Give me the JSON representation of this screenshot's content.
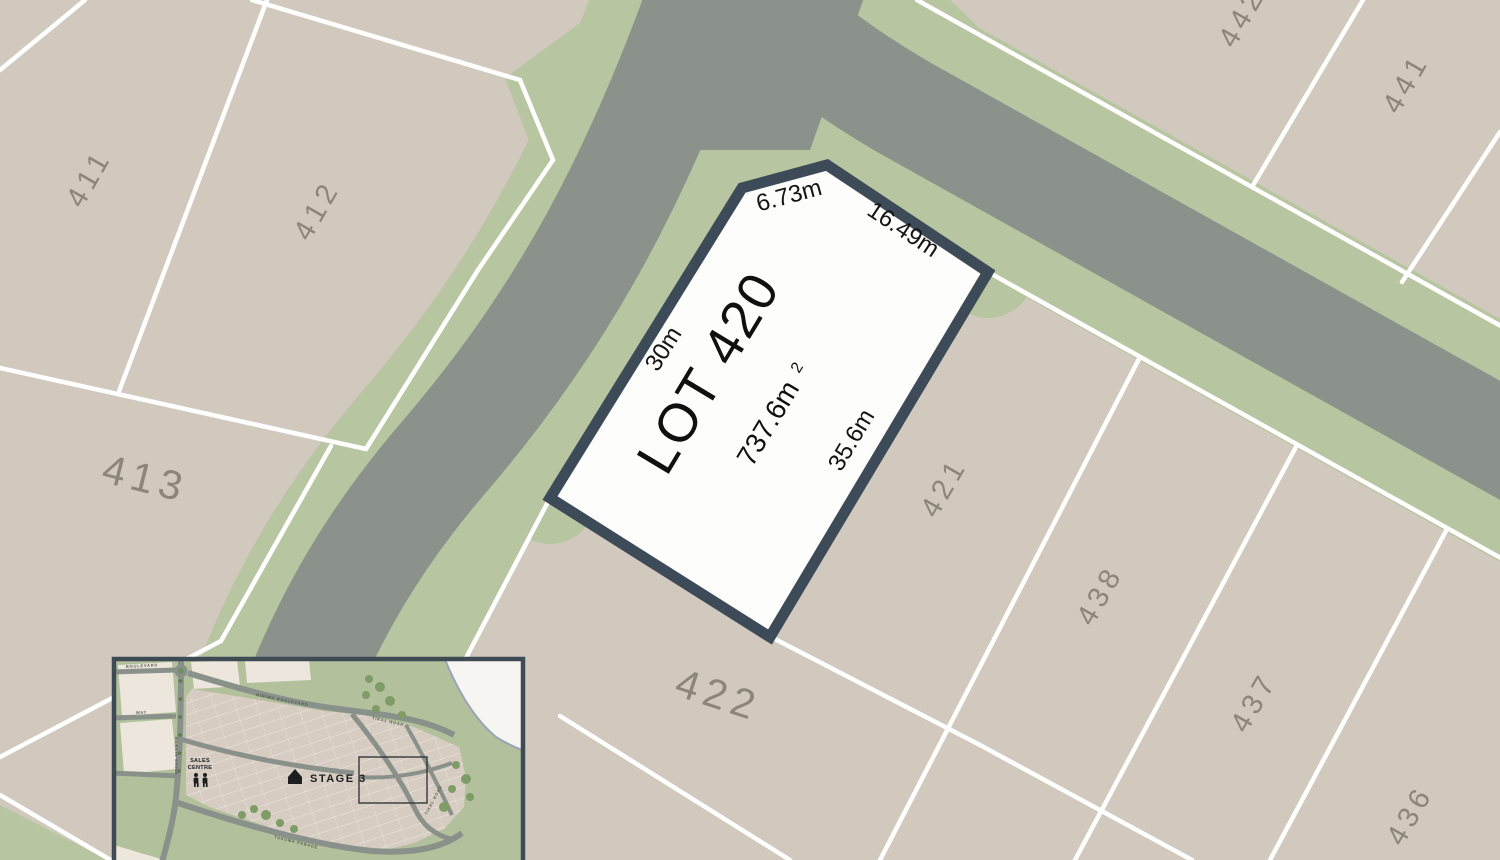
{
  "featured_lot": {
    "label": "LOT 420",
    "area_main": "737.6m",
    "area_sup": "2",
    "dimensions": {
      "top_left": "6.73m",
      "top_right": "16.49m",
      "left": "30m",
      "right": "35.6m"
    }
  },
  "lots": [
    {
      "label": "411"
    },
    {
      "label": "412"
    },
    {
      "label": "413"
    },
    {
      "label": "421"
    },
    {
      "label": "422"
    },
    {
      "label": "438"
    },
    {
      "label": "437"
    },
    {
      "label": "436"
    },
    {
      "label": "441"
    },
    {
      "label": "442"
    }
  ],
  "inset": {
    "stage_label": "STAGE 3",
    "sales_centre": [
      "SALES",
      "CENTRE"
    ],
    "roads": [
      "BIRIWA BOULEVARD",
      "TIKAL ROAD",
      "TIKAL ROAD",
      "BARKIN DRIVE",
      "TAKUMA PARADE",
      "BOULEVARD",
      "WAY"
    ]
  },
  "colors": {
    "lot_fill_beige": "#d2c9be",
    "road_gray": "#8b928b",
    "verge_green": "#b7c5a0",
    "boundary_white": "#ffffff",
    "featured_lot_fill": "#fdfdfb",
    "featured_lot_border": "#3c4b57",
    "lot_number_gray": "#8c857a",
    "dimension_text": "#141414",
    "inset_background": "#b2c19c",
    "inset_border": "#3f4b54"
  }
}
